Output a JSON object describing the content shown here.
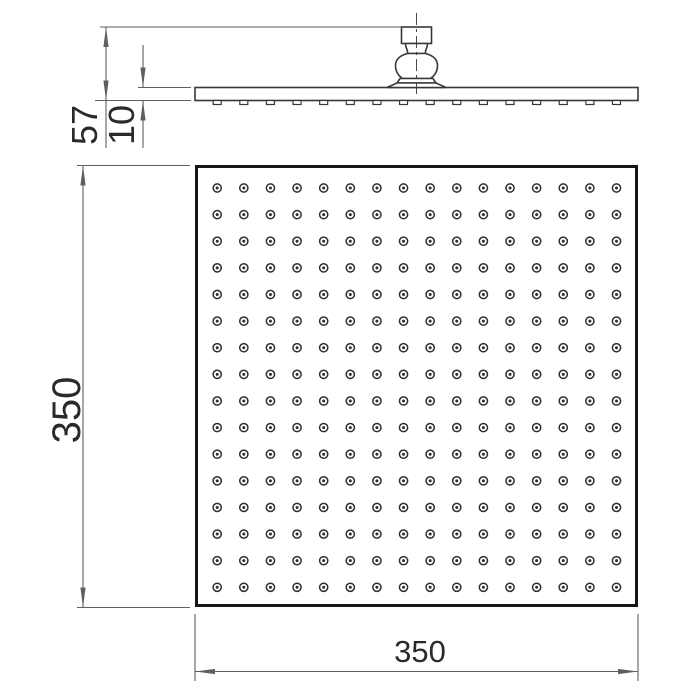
{
  "drawing": {
    "type": "technical-dimension-drawing",
    "subject": "square-rain-shower-head",
    "side_view": {
      "height_label": "57",
      "plate_thickness_label": "10",
      "nozzle_bumps": 16
    },
    "plan_view": {
      "width_label": "350",
      "height_label": "350",
      "nozzle_grid": {
        "rows": 16,
        "cols": 16
      }
    },
    "colors": {
      "background": "#ffffff",
      "object_line": "#383838",
      "heavy_outline": "#161616",
      "dimension_line": "#5f5f5f",
      "text": "#2a2a2a",
      "nozzle": "#2e2e2e"
    }
  }
}
